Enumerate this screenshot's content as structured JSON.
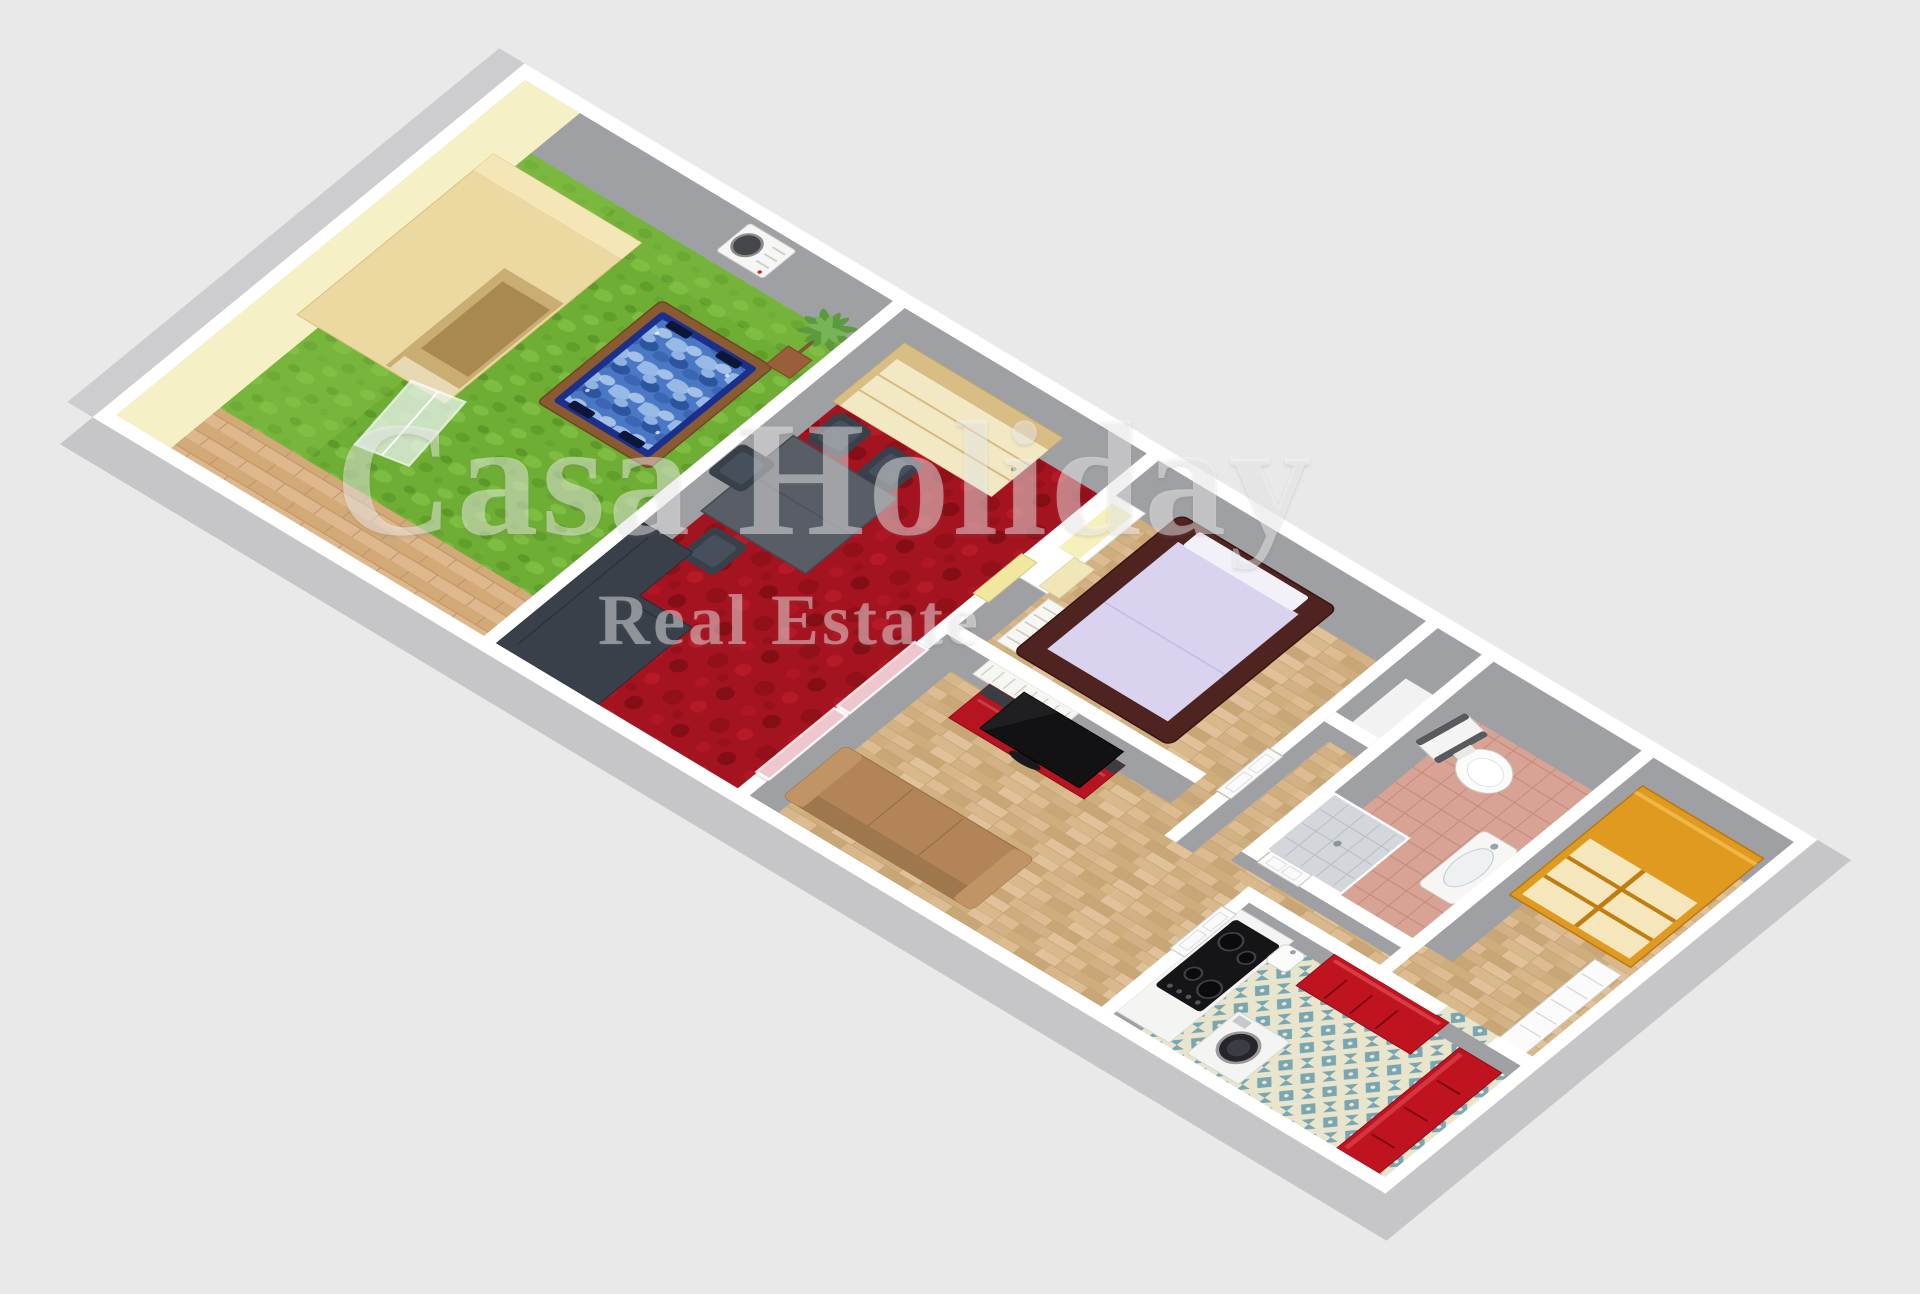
{
  "watermark": {
    "line1": "Casa Holiday",
    "line2": "Real Estate"
  },
  "palette": {
    "background": "#e9e9e9",
    "wall_top": "#ffffff",
    "wall_face": "#9fa0a3",
    "outer_face": "#c6c6c8",
    "outer_face_west": "#cdcdcf",
    "garden_wall_cream": "#f6f0c6",
    "grass": "#6fae35",
    "deck_wood": "#d9b183",
    "shed_wood": "#ecd9a2",
    "hot_tub_water": "#4a78c4",
    "hot_tub_rim": "#1b2f8c",
    "hot_tub_wood": "#8a5a33",
    "carpet_red": "#a41420",
    "wood_floor": "#d7b68a",
    "alcove_floor": "#f2f2f2",
    "wardrobe_cream": "#f2e8c4",
    "table_gray": "#585d66",
    "dark_furniture": "#39404a",
    "glass_pink": "#f0c2ca",
    "door_yellow": "#f2e79e",
    "bed_frame": "#4f2320",
    "bed_mattress": "#d9d3ef",
    "radiator_white": "#f6f6f2",
    "tv_screen": "#121214",
    "cabinet_red": "#b51420",
    "sofa_brown": "#b28457",
    "bath_tile": "#d8a394",
    "shower_gray": "#d3d6da",
    "kitchen_tile_blue": "#78a6b2",
    "kitchen_tile_cream": "#e9e4cc",
    "counter_red": "#c01320",
    "wardrobe_orange": "#e09a1f",
    "appliance_white": "#f4f4f2",
    "watermark_color": "rgba(255,255,255,0.42)"
  }
}
